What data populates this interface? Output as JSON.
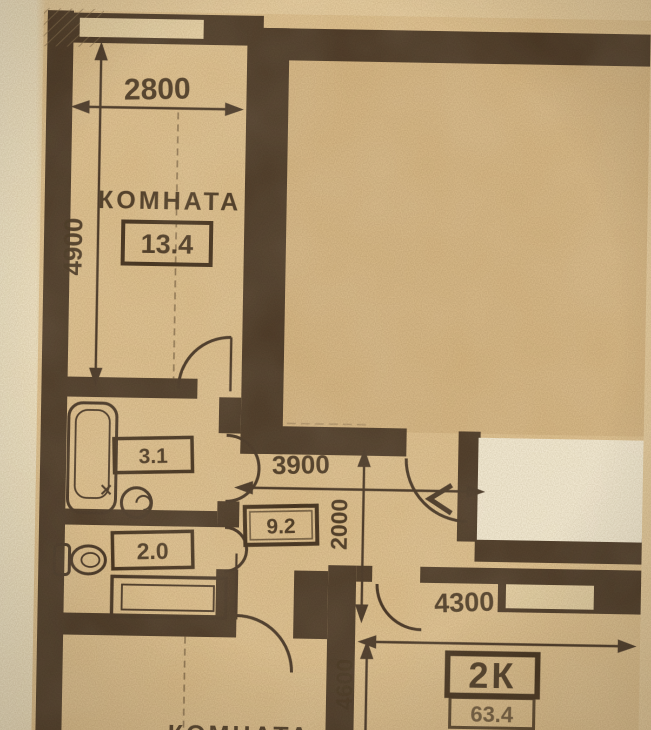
{
  "labels": {
    "room_top_name": "КОМНАТА",
    "room_top_area": "13.4",
    "bath_area": "3.1",
    "wc_area": "2.0",
    "hall_area": "9.2",
    "apartment_type": "2К",
    "apartment_total_area": "63.4",
    "room_bottom_name": "КОМНАТА",
    "entrance_mark": "<"
  },
  "dimensions_mm": {
    "room_top_width": "2800",
    "room_top_depth": "4900",
    "hall_width": "3900",
    "hall_depth": "2000",
    "room_bottom_right_width": "4300",
    "room_bottom_right_depth": "4600"
  },
  "colors": {
    "paper": "#e9cfa0",
    "margin": "#f3e8ca",
    "floor": "#e2c491",
    "floor_big_room": "#d9b985",
    "wall": "#4e3b27",
    "ink": "#47341f",
    "window": "#ead5a8",
    "patch": "#f8efd8"
  }
}
